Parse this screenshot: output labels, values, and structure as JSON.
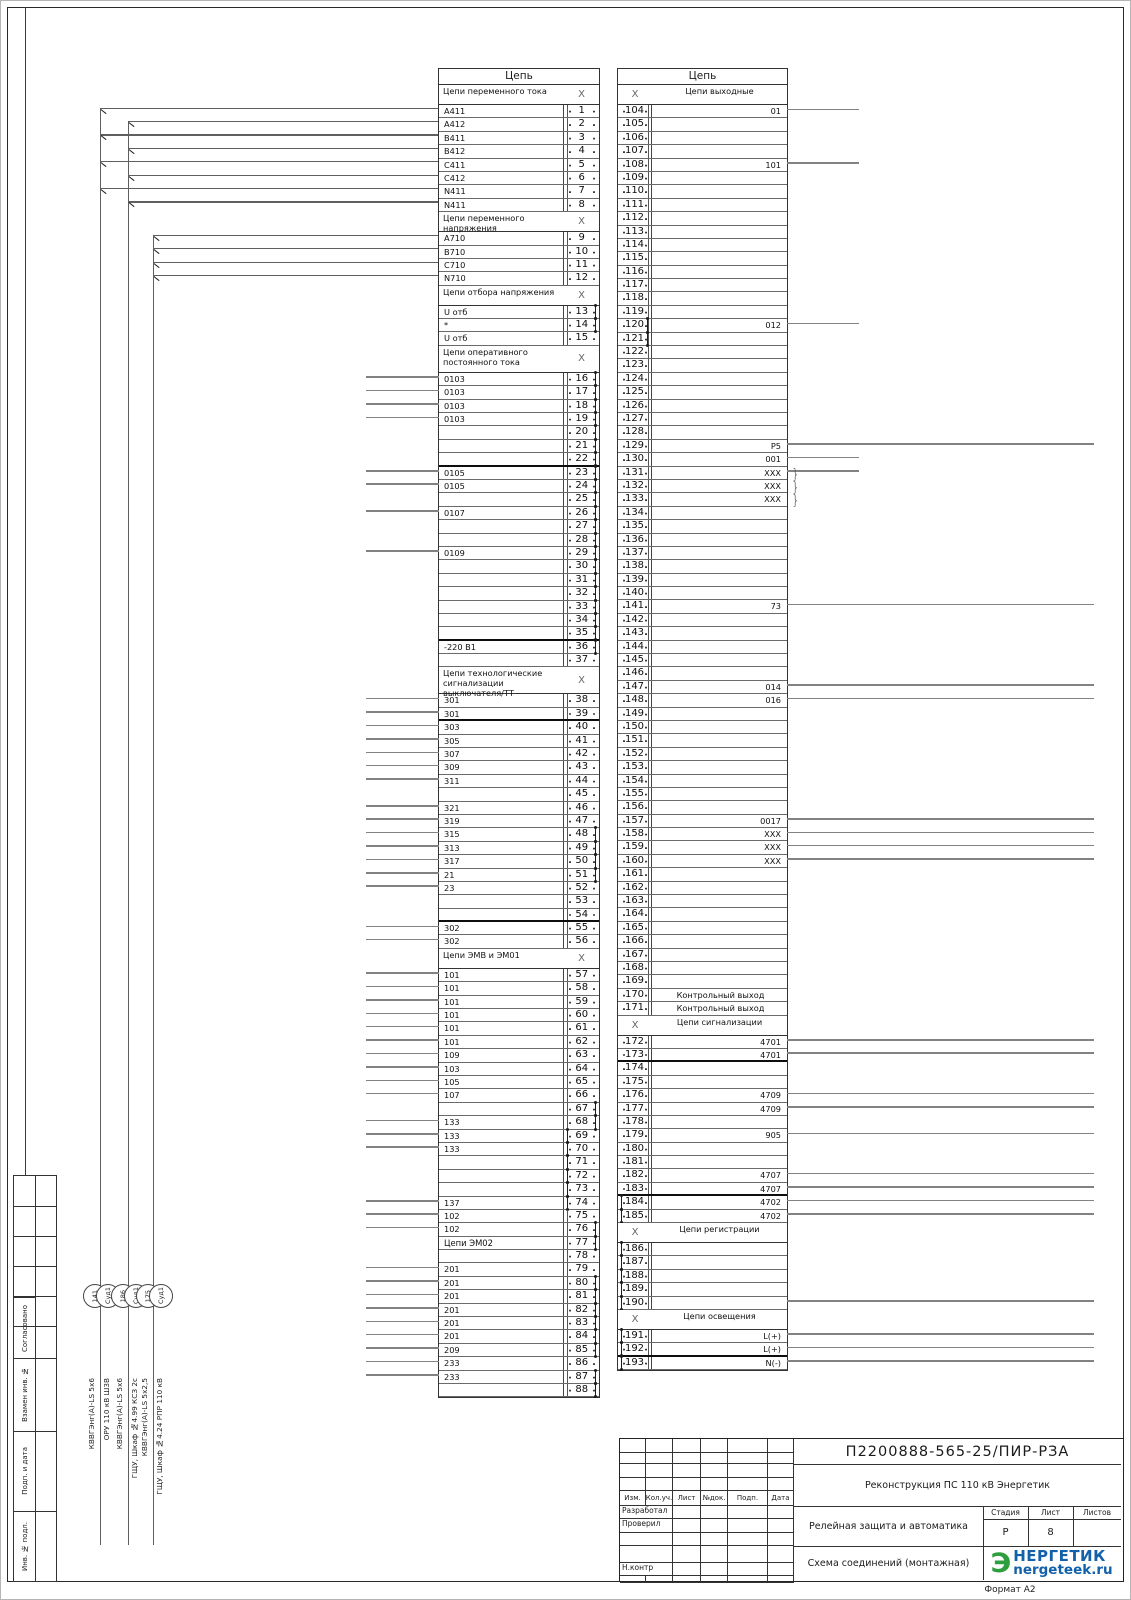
{
  "page": {
    "format": "Формат А2"
  },
  "glyphs": {
    "x": "X",
    "bracket": "}"
  },
  "margin": {
    "labels": [
      "Согласовано",
      "Взамен инв. №",
      "Подп. и дата",
      "Инв. № подл."
    ]
  },
  "cables": [
    {
      "num": "141",
      "tag": "Суд1",
      "type": "КВВГЭнг(А)-LS 5х6",
      "dest": "ОРУ 110 кВ Ш3В"
    },
    {
      "num": "186",
      "tag": "Суд1",
      "type": "КВВГЭнг(А)-LS 5х6",
      "dest": "ГЩУ, Шкаф №4.99 КСЗ 2с"
    },
    {
      "num": "175",
      "tag": "Суд1",
      "type": "КВВГЭнг(А)-LS 5х2,5",
      "dest": "ГЩУ, Шкаф №4.24 РПР 110 кВ"
    }
  ],
  "left_table": {
    "title": "Цепь",
    "rows": [
      {
        "h": "Цепи переменного тока"
      },
      {
        "n": 1,
        "t": "A411",
        "c": 1
      },
      {
        "n": 2,
        "t": "A412",
        "c": 2
      },
      {
        "n": 3,
        "t": "B411",
        "c": 1
      },
      {
        "n": 4,
        "t": "B412",
        "c": 2
      },
      {
        "n": 5,
        "t": "C411",
        "c": 1
      },
      {
        "n": 6,
        "t": "C412",
        "c": 2
      },
      {
        "n": 7,
        "t": "N411",
        "c": 1
      },
      {
        "n": 8,
        "t": "N411",
        "c": 2
      },
      {
        "h": "Цепи переменного напряжения"
      },
      {
        "n": 9,
        "t": "A710",
        "c": 3
      },
      {
        "n": 10,
        "t": "B710",
        "c": 3
      },
      {
        "n": 11,
        "t": "C710",
        "c": 3
      },
      {
        "n": 12,
        "t": "N710",
        "c": 3
      },
      {
        "h": "Цепи отбора напряжения"
      },
      {
        "n": 13,
        "t": "U отб",
        "j": "r"
      },
      {
        "n": 14,
        "t": "*",
        "j": "r"
      },
      {
        "n": 15,
        "t": "U отб"
      },
      {
        "h": "Цепи оперативного постоянного тока",
        "l": 2
      },
      {
        "n": 16,
        "t": "0103",
        "w": 1,
        "j": "r"
      },
      {
        "n": 17,
        "t": "0103",
        "w": 1,
        "j": "r"
      },
      {
        "n": 18,
        "t": "0103",
        "w": 1,
        "j": "r"
      },
      {
        "n": 19,
        "t": "0103",
        "w": 1,
        "j": "r"
      },
      {
        "n": 20,
        "j": "r"
      },
      {
        "n": 21,
        "j": "r"
      },
      {
        "n": 22,
        "j": "r",
        "b": 1
      },
      {
        "n": 23,
        "t": "0105",
        "w": 1,
        "j": "r"
      },
      {
        "n": 24,
        "t": "0105",
        "w": 1,
        "j": "r"
      },
      {
        "n": 25,
        "j": "r"
      },
      {
        "n": 26,
        "t": "0107",
        "w": 1,
        "j": "r"
      },
      {
        "n": 27,
        "j": "r"
      },
      {
        "n": 28,
        "j": "r"
      },
      {
        "n": 29,
        "t": "0109",
        "w": 1,
        "j": "r"
      },
      {
        "n": 30,
        "j": "r"
      },
      {
        "n": 31,
        "j": "r"
      },
      {
        "n": 32,
        "j": "r"
      },
      {
        "n": 33,
        "j": "r"
      },
      {
        "n": 34,
        "j": "r"
      },
      {
        "n": 35,
        "j": "r",
        "b": 1
      },
      {
        "n": 36,
        "t": "-220 В1",
        "j": "r"
      },
      {
        "n": 37
      },
      {
        "h": "Цепи технологические сигнализации выключателя/ТТ",
        "l": 2
      },
      {
        "n": 38,
        "t": "301",
        "w": 1
      },
      {
        "n": 39,
        "t": "301",
        "w": 1,
        "b": 1
      },
      {
        "n": 40,
        "t": "303",
        "w": 1
      },
      {
        "n": 41,
        "t": "305",
        "w": 1
      },
      {
        "n": 42,
        "t": "307",
        "w": 1
      },
      {
        "n": 43,
        "t": "309",
        "w": 1
      },
      {
        "n": 44,
        "t": "311",
        "w": 1
      },
      {
        "n": 45
      },
      {
        "n": 46,
        "t": "321",
        "w": 1
      },
      {
        "n": 47,
        "t": "319",
        "w": 1
      },
      {
        "n": 48,
        "t": "315",
        "w": 1,
        "j": "r"
      },
      {
        "n": 49,
        "t": "313",
        "w": 1,
        "j": "r"
      },
      {
        "n": 50,
        "t": "317",
        "w": 1,
        "j": "r"
      },
      {
        "n": 51,
        "t": "21",
        "w": 1,
        "j": "r"
      },
      {
        "n": 52,
        "t": "23",
        "w": 1
      },
      {
        "n": 53
      },
      {
        "n": 54,
        "b": 1
      },
      {
        "n": 55,
        "t": "302",
        "w": 1
      },
      {
        "n": 56,
        "t": "302",
        "w": 1
      },
      {
        "h": "Цепи ЭМВ и ЭМ01"
      },
      {
        "n": 57,
        "t": "101",
        "w": 1
      },
      {
        "n": 58,
        "t": "101",
        "w": 1
      },
      {
        "n": 59,
        "t": "101",
        "w": 1
      },
      {
        "n": 60,
        "t": "101",
        "w": 1
      },
      {
        "n": 61,
        "t": "101",
        "w": 1
      },
      {
        "n": 62,
        "t": "101",
        "w": 1
      },
      {
        "n": 63,
        "t": "109",
        "w": 1
      },
      {
        "n": 64,
        "t": "103",
        "w": 1
      },
      {
        "n": 65,
        "t": "105",
        "w": 1
      },
      {
        "n": 66,
        "t": "107",
        "w": 1
      },
      {
        "n": 67,
        "j": "r"
      },
      {
        "n": 68,
        "t": "133",
        "w": 1,
        "j": "r"
      },
      {
        "n": 69,
        "t": "133",
        "w": 1,
        "j": "l"
      },
      {
        "n": 70,
        "t": "133",
        "w": 1,
        "j": "l"
      },
      {
        "n": 71,
        "j": "l"
      },
      {
        "n": 72,
        "j": "l"
      },
      {
        "n": 73,
        "j": "l"
      },
      {
        "n": 74,
        "t": "137",
        "w": 1,
        "j": "l"
      },
      {
        "n": 75,
        "t": "102",
        "w": 1
      },
      {
        "n": 76,
        "t": "102",
        "w": 1,
        "j": "r"
      },
      {
        "n": 77,
        "t": "Цепи ЭМ02",
        "sh": 1,
        "j": "r"
      },
      {
        "n": 78
      },
      {
        "n": 79,
        "t": "201",
        "w": 1
      },
      {
        "n": 80,
        "t": "201",
        "w": 1,
        "j": "r"
      },
      {
        "n": 81,
        "t": "201",
        "w": 1,
        "j": "r"
      },
      {
        "n": 82,
        "t": "201",
        "w": 1,
        "j": "r"
      },
      {
        "n": 83,
        "t": "201",
        "w": 1,
        "j": "r"
      },
      {
        "n": 84,
        "t": "201",
        "w": 1,
        "j": "r"
      },
      {
        "n": 85,
        "t": "209",
        "w": 1,
        "j": "r"
      },
      {
        "n": 86,
        "t": "233",
        "w": 1
      },
      {
        "n": 87,
        "t": "233",
        "w": 1,
        "j": "r"
      },
      {
        "n": 88,
        "j": "r"
      }
    ]
  },
  "right_table": {
    "title": "Цепь",
    "rows": [
      {
        "h": "Цепи выходные"
      },
      {
        "n": 104,
        "t": "01",
        "w": 1
      },
      {
        "n": 105
      },
      {
        "n": 106
      },
      {
        "n": 107
      },
      {
        "n": 108,
        "t": "101",
        "w": 1
      },
      {
        "n": 109
      },
      {
        "n": 110
      },
      {
        "n": 111
      },
      {
        "n": 112
      },
      {
        "n": 113
      },
      {
        "n": 114
      },
      {
        "n": 115
      },
      {
        "n": 116
      },
      {
        "n": 117
      },
      {
        "n": 118
      },
      {
        "n": 119
      },
      {
        "n": 120,
        "t": "012",
        "w": 1,
        "j": "r"
      },
      {
        "n": 121,
        "j": "r"
      },
      {
        "n": 122
      },
      {
        "n": 123
      },
      {
        "n": 124
      },
      {
        "n": 125
      },
      {
        "n": 126
      },
      {
        "n": 127
      },
      {
        "n": 128
      },
      {
        "n": 129,
        "t": "P5",
        "w": 2
      },
      {
        "n": 130,
        "t": "001",
        "w": 1
      },
      {
        "n": 131,
        "t": "XXX",
        "w": 1,
        "k": 1
      },
      {
        "n": 132,
        "t": "XXX",
        "k": 1
      },
      {
        "n": 133,
        "t": "XXX",
        "k": 1
      },
      {
        "n": 134
      },
      {
        "n": 135
      },
      {
        "n": 136
      },
      {
        "n": 137
      },
      {
        "n": 138
      },
      {
        "n": 139
      },
      {
        "n": 140
      },
      {
        "n": 141,
        "t": "73",
        "w": 2
      },
      {
        "n": 142
      },
      {
        "n": 143
      },
      {
        "n": 144
      },
      {
        "n": 145
      },
      {
        "n": 146
      },
      {
        "n": 147,
        "t": "014",
        "w": 2
      },
      {
        "n": 148,
        "t": "016",
        "w": 2
      },
      {
        "n": 149
      },
      {
        "n": 150
      },
      {
        "n": 151
      },
      {
        "n": 152
      },
      {
        "n": 153
      },
      {
        "n": 154
      },
      {
        "n": 155
      },
      {
        "n": 156
      },
      {
        "n": 157,
        "t": "0017",
        "w": 2
      },
      {
        "n": 158,
        "t": "XXX",
        "w": 2
      },
      {
        "n": 159,
        "t": "XXX",
        "w": 2
      },
      {
        "n": 160,
        "t": "XXX",
        "w": 2
      },
      {
        "n": 161
      },
      {
        "n": 162
      },
      {
        "n": 163
      },
      {
        "n": 164
      },
      {
        "n": 165
      },
      {
        "n": 166
      },
      {
        "n": 167
      },
      {
        "n": 168
      },
      {
        "n": 169
      },
      {
        "n": 170,
        "t": "Контрольный выход",
        "a": 1
      },
      {
        "n": 171,
        "t": "Контрольный выход",
        "a": 1
      },
      {
        "h": "Цепи сигнализации"
      },
      {
        "n": 172,
        "t": "4701",
        "w": 2
      },
      {
        "n": 173,
        "t": "4701",
        "w": 2,
        "b": 1
      },
      {
        "n": 174
      },
      {
        "n": 175
      },
      {
        "n": 176,
        "t": "4709",
        "w": 2
      },
      {
        "n": 177,
        "t": "4709",
        "w": 2
      },
      {
        "n": 178
      },
      {
        "n": 179,
        "t": "905",
        "w": 2
      },
      {
        "n": 180
      },
      {
        "n": 181
      },
      {
        "n": 182,
        "t": "4707",
        "w": 2
      },
      {
        "n": 183,
        "t": "4707",
        "w": 2,
        "b": 1
      },
      {
        "n": 184,
        "t": "4702",
        "w": 2,
        "j": "l"
      },
      {
        "n": 185,
        "t": "4702",
        "w": 2,
        "j": "l"
      },
      {
        "h": "Цепи регистрации"
      },
      {
        "n": 186,
        "j": "l"
      },
      {
        "n": 187,
        "j": "l"
      },
      {
        "n": 188,
        "j": "l"
      },
      {
        "n": 189,
        "j": "l"
      },
      {
        "n": 190,
        "w": 2,
        "j": "l"
      },
      {
        "h": "Цепи освещения"
      },
      {
        "n": 191,
        "t": "L(+)",
        "w": 2,
        "j": "l"
      },
      {
        "n": 192,
        "t": "L(+)",
        "w": 2,
        "j": "l",
        "b": 1
      },
      {
        "n": 193,
        "t": "N(-)",
        "w": 2,
        "j": "l"
      }
    ]
  },
  "title_block": {
    "doc_number": "П2200888-565-25/ПИР-РЗА",
    "project": "Реконструкция ПС 110 кВ Энергетик",
    "object_name": "Релейная защита и автоматика",
    "drawing_name": "Схема соединений (монтажная)",
    "cols": [
      "Изм.",
      "Кол.уч.",
      "Лист",
      "№док.",
      "Подп.",
      "Дата"
    ],
    "roles": [
      "Разработал",
      "Проверил",
      "",
      "",
      "Н.контр"
    ],
    "stage_label": "Стадия",
    "sheet_label": "Лист",
    "sheets_label": "Листов",
    "stage": "Р",
    "sheet": "8",
    "sheets": "",
    "logo": {
      "e": "Э",
      "line1": "НЕРГЕТИК",
      "line2": "nergeteek.ru",
      "green": "#2f9e3f",
      "blue": "#1261ab"
    }
  }
}
